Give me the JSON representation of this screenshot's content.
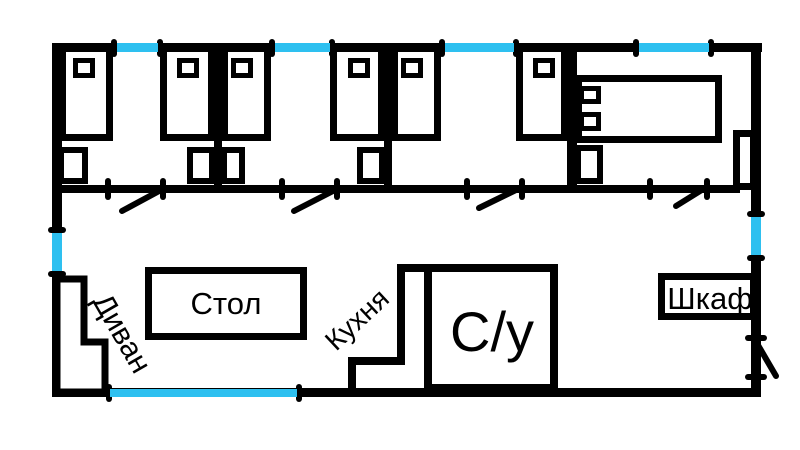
{
  "diagram": {
    "type": "floor-plan",
    "background": "#ffffff"
  },
  "colors": {
    "wall": "#000000",
    "window": "#2ec0f0",
    "fill": "#ffffff",
    "text": "#000000"
  },
  "labels": {
    "sofa": "Диван",
    "table": "Стол",
    "kitchen": "Кухня",
    "bathroom": "С/у",
    "wardrobe": "Шкаф"
  },
  "inventory": {
    "bedrooms": 4,
    "single_beds": 6,
    "double_beds": 1,
    "nightstands": 5,
    "windows": 7,
    "interior_doors": 4,
    "entrance_doors": 1
  }
}
